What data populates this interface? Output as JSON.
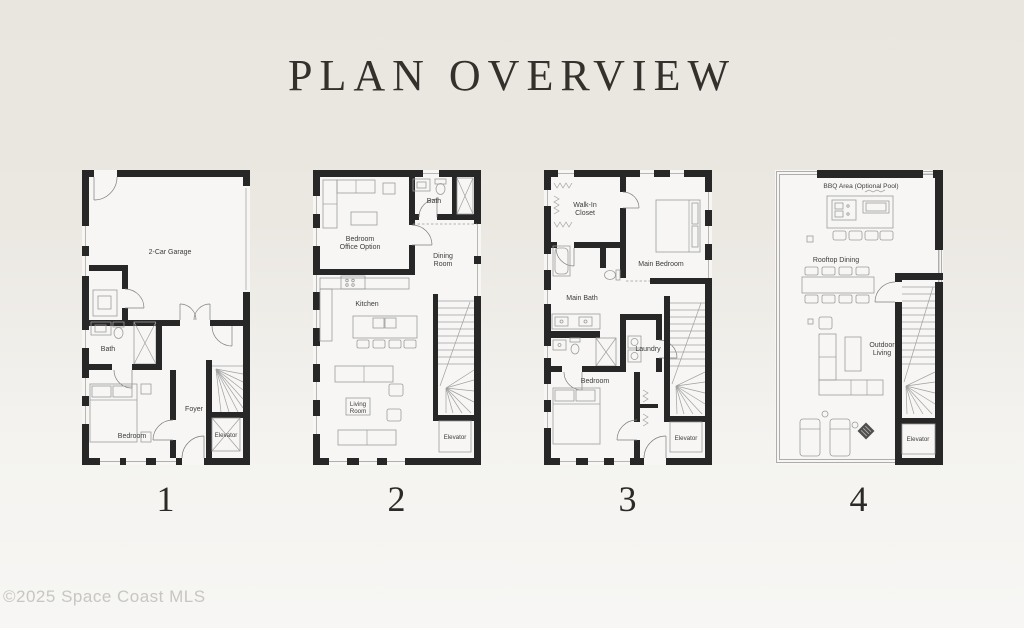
{
  "title": "PLAN OVERVIEW",
  "watermark": "©2025 Space Coast MLS",
  "colors": {
    "background_top": "#e9e5df",
    "background_bottom": "#f7f6f4",
    "wall": "#272727",
    "plan_floor": "#f7f6f5",
    "label_text": "#3c3c3c",
    "title_text": "#34312d",
    "watermark_text": "#c9c6c2"
  },
  "plans": [
    {
      "number": "1",
      "labels": {
        "garage": "2-Car Garage",
        "bath": "Bath",
        "bedroom": "Bedroom",
        "foyer": "Foyer",
        "elevator": "Elevator"
      }
    },
    {
      "number": "2",
      "labels": {
        "bedroom_office_line1": "Bedroom",
        "bedroom_office_line2": "Office Option",
        "bath": "Bath",
        "dining_line1": "Dining",
        "dining_line2": "Room",
        "kitchen": "Kitchen",
        "living_line1": "Living",
        "living_line2": "Room",
        "elevator": "Elevator"
      }
    },
    {
      "number": "3",
      "labels": {
        "walk_in_line1": "Walk-In",
        "walk_in_line2": "Closet",
        "main_bedroom": "Main Bedroom",
        "main_bath": "Main Bath",
        "laundry": "Laundry",
        "bedroom": "Bedroom",
        "elevator": "Elevator"
      }
    },
    {
      "number": "4",
      "labels": {
        "bbq": "BBQ Area (Optional Pool)",
        "rooftop_dining": "Rooftop Dining",
        "outdoor_line1": "Outdoor",
        "outdoor_line2": "Living",
        "elevator": "Elevator"
      }
    }
  ]
}
